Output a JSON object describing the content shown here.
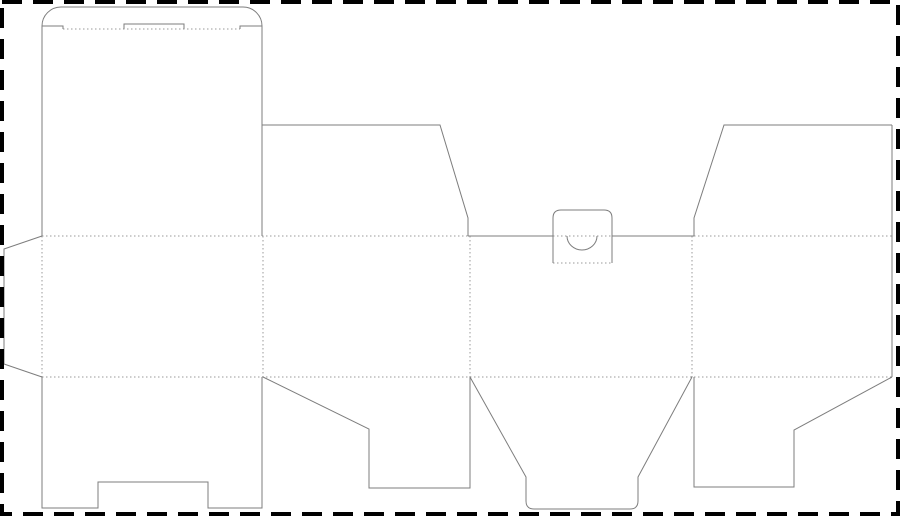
{
  "drawing": {
    "kind": "dieline-template",
    "canvas": {
      "width": 900,
      "height": 516,
      "background": "#ffffff"
    },
    "styles": {
      "cut_line_color": "#7d7d7d",
      "cut_line_width": 1,
      "fold_line_color": "#9a9a9a",
      "fold_line_width": 1,
      "fold_dash": "1.5 2.5",
      "border_color": "#000000",
      "border_width": 4,
      "border_dash": "20 11"
    },
    "border": {
      "x": 2,
      "y": 2,
      "width": 896,
      "height": 512
    },
    "cut_lines": [
      {
        "name": "lid-flap-rounded-outline",
        "d": "M 42 26 A 19 19 0 0 1 61 7 L 243 7 A 19 19 0 0 1 262 26"
      },
      {
        "name": "lid-shoulder-left",
        "d": "M 42 26 L 63 26 L 63 29"
      },
      {
        "name": "lid-shoulder-right",
        "d": "M 240 29 L 240 26 L 262 26"
      },
      {
        "name": "lid-lock-slit-tab",
        "d": "M 124 29 L 124 24 L 184 24 L 184 29"
      },
      {
        "name": "back-panel-left-edge",
        "d": "M 42 26 L 42 236"
      },
      {
        "name": "back-panel-right-edge",
        "d": "M 262 26 L 262 236"
      },
      {
        "name": "glue-flap-outline",
        "d": "M 42 236 L 4 249 L 4 364 L 42 377"
      },
      {
        "name": "top-dust-flap-left-outline",
        "d": "M 262 125 L 440 125 L 468 218 L 468 236"
      },
      {
        "name": "top-dust-flap-right-outline",
        "d": "M 892 125 L 724 125 L 694 218 L 694 236"
      },
      {
        "name": "right-panel-edge",
        "d": "M 892 125 L 892 377"
      },
      {
        "name": "front-panel-top-edge-left",
        "d": "M 468 236 L 553 236"
      },
      {
        "name": "front-panel-top-edge-right",
        "d": "M 612 236 L 694 236"
      },
      {
        "name": "thumb-tab-outline",
        "d": "M 553 263 L 553 218 Q 553 210 561 210 L 604 210 Q 612 210 612 218 L 612 263"
      },
      {
        "name": "thumb-notch-semicircle",
        "d": "M 567 236 A 15 14 0 0 0 597 236"
      },
      {
        "name": "bottom-flap-back-outline",
        "d": "M 42 377 L 42 508 L 98 508 L 98 482 L 208 482 L 208 508 L 262 508 L 262 377"
      },
      {
        "name": "bottom-dust-flap-left-outline",
        "d": "M 263 377 L 369 429 L 369 488 L 470 488 L 470 377"
      },
      {
        "name": "bottom-tuck-flap-outline",
        "d": "M 470 377 L 526 477 L 526 501 Q 526 509 534 509 L 630 509 Q 638 509 638 501 L 638 477 L 692 377"
      },
      {
        "name": "bottom-dust-flap-right-outline",
        "d": "M 694 377 L 694 487 L 794 487 L 794 430 L 892 377"
      }
    ],
    "fold_lines": [
      {
        "name": "lid-crease",
        "d": "M 63 29 L 240 29"
      },
      {
        "name": "top-crease-left-section",
        "d": "M 42 236 L 468 236"
      },
      {
        "name": "thumb-tab-crease",
        "d": "M 553 236 L 612 236"
      },
      {
        "name": "top-crease-right-section",
        "d": "M 694 236 L 892 236"
      },
      {
        "name": "bottom-crease",
        "d": "M 42 377 L 892 377"
      },
      {
        "name": "glue-flap-crease",
        "d": "M 42 236 L 42 377"
      },
      {
        "name": "panel-crease-1",
        "d": "M 263 236 L 263 377"
      },
      {
        "name": "panel-crease-2",
        "d": "M 470 236 L 470 377"
      },
      {
        "name": "panel-crease-3",
        "d": "M 692 236 L 692 377"
      },
      {
        "name": "thumb-tab-base-crease",
        "d": "M 553 263 L 612 263"
      }
    ]
  }
}
